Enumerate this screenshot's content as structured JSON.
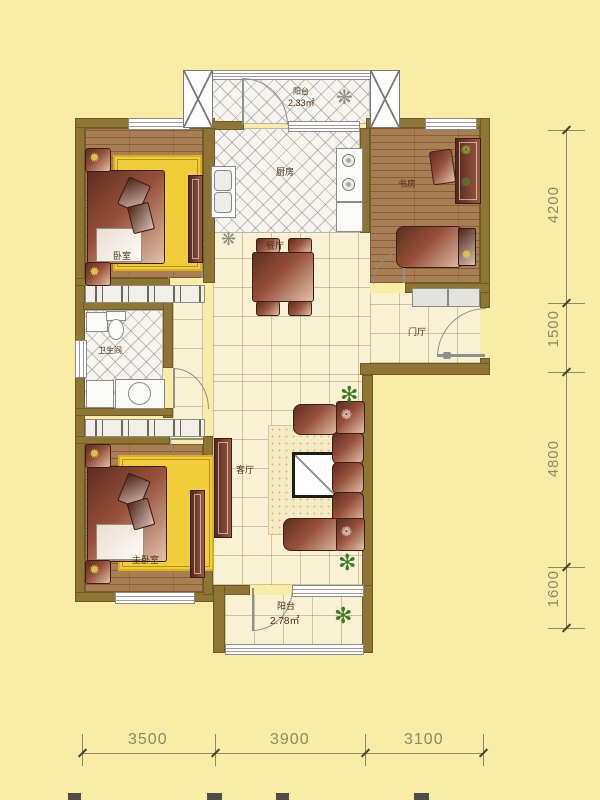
{
  "rooms": {
    "bedroom": {
      "label": "卧室"
    },
    "kitchen": {
      "label": "厨房"
    },
    "study": {
      "label": "书房"
    },
    "dining": {
      "label": "餐厅"
    },
    "foyer": {
      "label": "门厅"
    },
    "bathroom": {
      "label": "卫生间"
    },
    "living": {
      "label": "客厅"
    },
    "master_bedroom": {
      "label": "主卧室"
    },
    "balcony_top": {
      "label": "阳台",
      "area": "2.33㎡"
    },
    "balcony_bottom": {
      "label": "阳台",
      "area": "2.78㎡"
    }
  },
  "dimensions": {
    "right": [
      "4200",
      "1500",
      "4800",
      "1600"
    ],
    "bottom": [
      "3500",
      "3900",
      "3100"
    ]
  },
  "icons": {
    "plant": "✻",
    "snowflake": "❋",
    "lamp": "✹",
    "flower": "❁"
  },
  "colors": {
    "background": "#F9ECA6",
    "wall": "#8F7534",
    "wood_floor": "#A97E52",
    "rug": "#F1CD39",
    "dimension": "#8E8866"
  }
}
